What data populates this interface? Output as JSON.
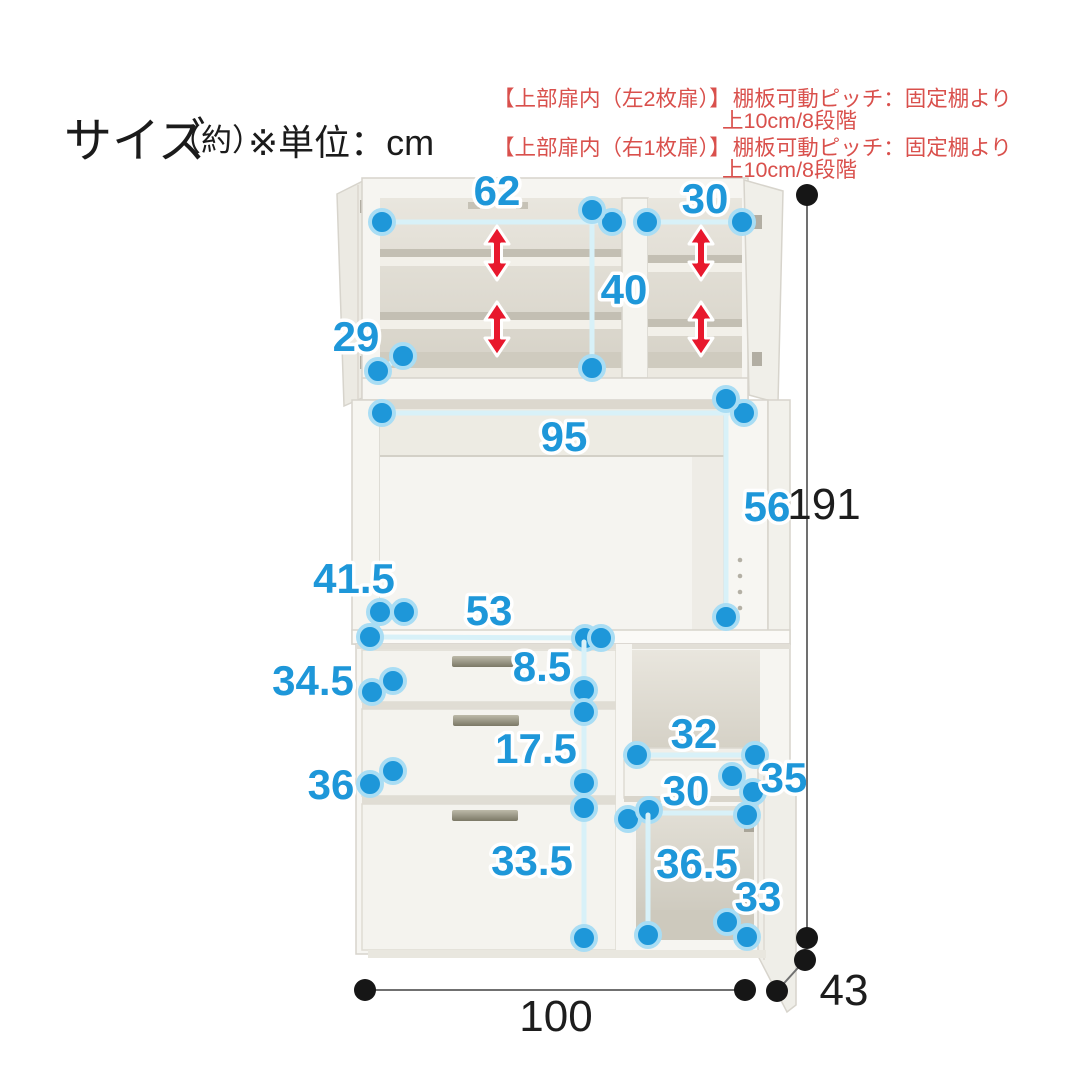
{
  "title": {
    "size_label": "サイズ",
    "approx": "（約）",
    "unit_note": "※単位：cm"
  },
  "notes": {
    "left_door": {
      "heading": "【上部扉内（左2枚扉）】",
      "pitch": "棚板可動ピッチ：固定棚より",
      "pitch2": "上10cm/8段階"
    },
    "right_door": {
      "heading": "【上部扉内（右1枚扉）】",
      "pitch": "棚板可動ピッチ：固定棚より",
      "pitch2": "上10cm/8段階"
    }
  },
  "dims": {
    "upper_left_inner_width": "62",
    "upper_right_inner_width": "30",
    "upper_inner_height": "40",
    "upper_shelf_depth": "29",
    "middle_open_width": "95",
    "middle_open_height": "56",
    "counter_leader": "41.5",
    "drawer_inner_width": "53",
    "drawer1_inner_height": "8.5",
    "drawer2_inner_height": "17.5",
    "drawer3_inner_height": "33.5",
    "left_upper_panel": "34.5",
    "left_lower_panel": "36",
    "right_niche_width": "32",
    "right_drawer_leader": "35",
    "right_door_inner_width": "30",
    "right_door_inner_height": "36.5",
    "right_door_leader": "33",
    "overall_width": "100",
    "overall_height": "191",
    "overall_depth": "43"
  },
  "colors": {
    "dim_blue": "#1e97d9",
    "dim_line_cyan": "#d8f1f8",
    "dim_black": "#1d1d1d",
    "note_red": "#d9504c",
    "arrow_red": "#e8182d",
    "background": "#ffffff"
  }
}
